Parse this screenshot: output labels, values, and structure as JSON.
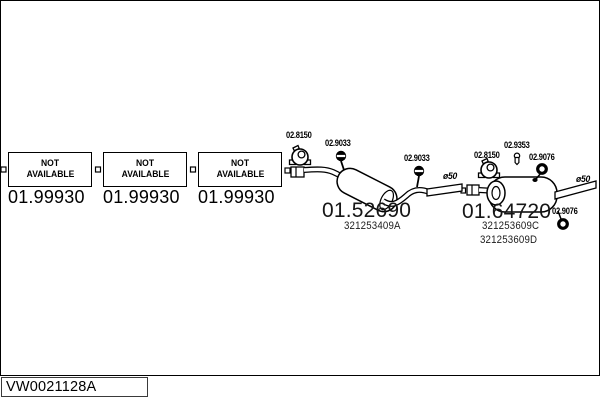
{
  "window": {
    "background_color": "#ffffff",
    "line_color": "#000000"
  },
  "placeholder_boxes": [
    {
      "status_line1": "NOT",
      "status_line2": "AVAILABLE",
      "part_number": "01.99930"
    },
    {
      "status_line1": "NOT",
      "status_line2": "AVAILABLE",
      "part_number": "01.99930"
    },
    {
      "status_line1": "NOT",
      "status_line2": "AVAILABLE",
      "part_number": "01.99930"
    }
  ],
  "middle_silencer": {
    "part_number": "01.52690",
    "oem_ref": "321253409A",
    "clamp_label": "02.8150",
    "hanger_label_1": "02.9033",
    "hanger_label_2": "02.9033",
    "diameter_label": "ø50"
  },
  "rear_silencer": {
    "part_number": "01.64720",
    "oem_ref_1": "321253609C",
    "oem_ref_2": "321253609D",
    "clamp_label": "02.8150",
    "bolt_label": "02.9353",
    "ring_label_1": "02.9076",
    "ring_label_2": "02.9076",
    "diameter_label": "ø50"
  },
  "footer": {
    "drawing_code": "VW0021128A"
  },
  "icons": {
    "clamp": "pipe-clamp-icon",
    "hanger": "rubber-hanger-icon",
    "bolt": "bolt-icon",
    "ring": "ring-gasket-icon",
    "connector": "connector-square"
  }
}
